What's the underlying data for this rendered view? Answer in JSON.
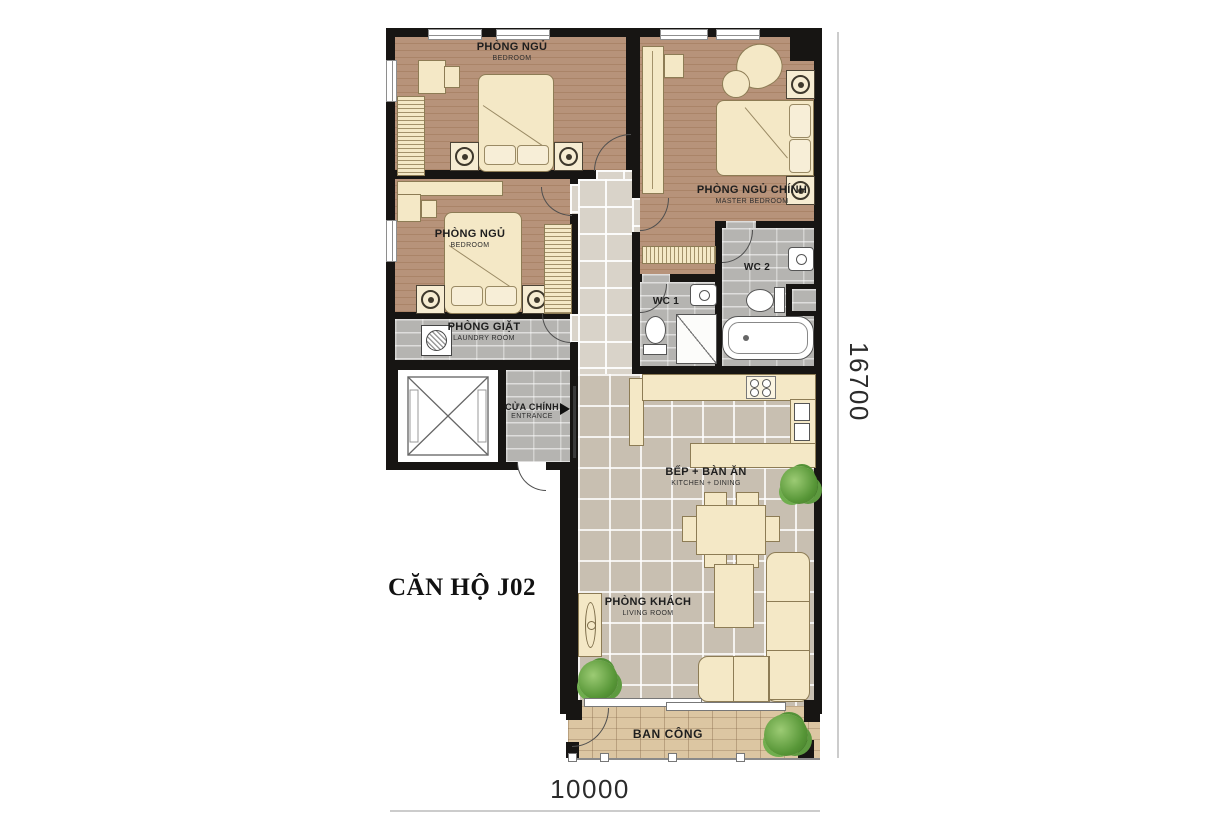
{
  "title": "CĂN HỘ J02",
  "dimensions": {
    "bottom": "10000",
    "right": "16700"
  },
  "rooms": {
    "bedroom1": {
      "vn": "PHÒNG NGỦ",
      "en": "BEDROOM"
    },
    "bedroom2": {
      "vn": "PHÒNG NGỦ",
      "en": "BEDROOM"
    },
    "master_bedroom": {
      "vn": "PHÒNG NGỦ CHÍNH",
      "en": "MASTER BEDROOM"
    },
    "wc1": {
      "vn": "WC 1"
    },
    "wc2": {
      "vn": "WC 2"
    },
    "laundry": {
      "vn": "PHÒNG GIẶT",
      "en": "LAUNDRY ROOM"
    },
    "entrance": {
      "vn": "CỬA CHÍNH",
      "en": "ENTRANCE"
    },
    "kitchen_dining": {
      "vn": "BẾP + BÀN ĂN",
      "en": "KITCHEN + DINING"
    },
    "living": {
      "vn": "PHÒNG KHÁCH",
      "en": "LIVING ROOM"
    },
    "balcony": {
      "vn": "BAN CÔNG"
    }
  },
  "colors": {
    "wall": "#171513",
    "wood_floor": "#b7937a",
    "hall_tile": "#d9d3c9",
    "living_tile": "#c8bfb1",
    "wet_room_tile": "#b5b4b1",
    "balcony_deck": "#dcc6a2",
    "furniture": "#f4e8c6",
    "plant": "#579637",
    "dimension_line": "#cccccc"
  }
}
